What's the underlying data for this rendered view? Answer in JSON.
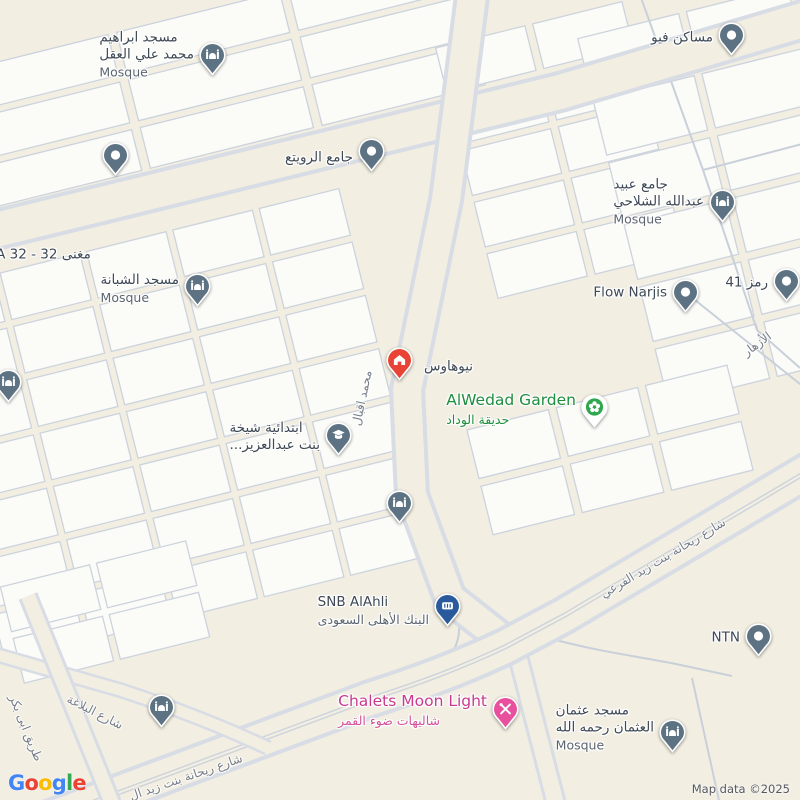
{
  "map": {
    "attribution": "Map data ©2025",
    "logo_letters": [
      {
        "ch": "G",
        "color": "#4285F4"
      },
      {
        "ch": "o",
        "color": "#EA4335"
      },
      {
        "ch": "o",
        "color": "#FBBC05"
      },
      {
        "ch": "g",
        "color": "#4285F4"
      },
      {
        "ch": "l",
        "color": "#34A853"
      },
      {
        "ch": "e",
        "color": "#EA4335"
      }
    ],
    "colors": {
      "background": "#f2eee2",
      "block": "#fbfbf8",
      "road_line": "#ccd3dd",
      "pin_slate": "#5d7383",
      "pin_red": "#e94335",
      "pin_green": "#2fa74e",
      "pin_blue": "#2a5a9c",
      "pin_pink": "#e8509e",
      "label_green": "#1e8e3e",
      "label_pink": "#c93a8e"
    }
  },
  "pois": [
    {
      "id": "masjid-ibrahim",
      "type": "mosque",
      "pin": {
        "x": 212,
        "y": 55
      },
      "label": {
        "lines": [
          "مسجد ابراهيم",
          "محمد علي العقل"
        ],
        "sub": "Mosque",
        "x": 194,
        "y": 55,
        "align": "right"
      }
    },
    {
      "id": "dot-west",
      "type": "dot",
      "pin": {
        "x": 115,
        "y": 155
      }
    },
    {
      "id": "jame-rowaita",
      "type": "dot",
      "pin": {
        "x": 371,
        "y": 151
      },
      "label": {
        "lines": [
          "جامع الرويتع"
        ],
        "x": 353,
        "y": 158,
        "align": "right"
      }
    },
    {
      "id": "masaken-view",
      "type": "dot",
      "pin": {
        "x": 731,
        "y": 35
      },
      "label": {
        "lines": [
          "مساكن فيو"
        ],
        "x": 713,
        "y": 38,
        "align": "right"
      }
    },
    {
      "id": "jame-obaid-alshalahi",
      "type": "mosque",
      "pin": {
        "x": 722,
        "y": 202
      },
      "label": {
        "lines": [
          "جامع عبيد",
          "عبدالله الشلاحي"
        ],
        "sub": "Mosque",
        "x": 704,
        "y": 202,
        "align": "right"
      }
    },
    {
      "id": "masjid-shabana",
      "type": "mosque",
      "pin": {
        "x": 197,
        "y": 286
      },
      "label": {
        "lines": [
          "مسجد الشبانة"
        ],
        "sub": "Mosque",
        "x": 179,
        "y": 289,
        "align": "right"
      }
    },
    {
      "id": "flow-narjis",
      "type": "dot",
      "pin": {
        "x": 685,
        "y": 292
      },
      "label": {
        "lines": [
          "Flow Narjis"
        ],
        "x": 667,
        "y": 293,
        "align": "right"
      }
    },
    {
      "id": "ramz-41",
      "type": "dot",
      "pin": {
        "x": 786,
        "y": 281
      },
      "label": {
        "lines": [
          "رمز 41"
        ],
        "x": 768,
        "y": 283,
        "align": "right"
      }
    },
    {
      "id": "mosque-west-edge",
      "type": "mosque",
      "pin": {
        "x": 8,
        "y": 382
      }
    },
    {
      "id": "newhouse",
      "type": "house",
      "pin": {
        "x": 399,
        "y": 360
      },
      "label": {
        "lines": [
          "نيوهاوس"
        ],
        "x": 424,
        "y": 367,
        "align": "left"
      }
    },
    {
      "id": "alwedad-garden",
      "type": "garden",
      "pin": {
        "x": 594,
        "y": 407
      },
      "label": {
        "lines": [
          "AlWedad Garden"
        ],
        "sub": "حديقة الوداد",
        "x": 576,
        "y": 410,
        "align": "right",
        "color": "#1e8e3e",
        "sub_color": "#1e8e3e",
        "big": true
      }
    },
    {
      "id": "school-shaikha-bint-abdulaziz",
      "type": "school",
      "pin": {
        "x": 338,
        "y": 435
      },
      "label": {
        "lines": [
          "ابتدائية شيخة",
          "بنت عبدالعزيز..."
        ],
        "x": 320,
        "y": 437,
        "align": "right"
      }
    },
    {
      "id": "mosque-mid",
      "type": "mosque",
      "pin": {
        "x": 399,
        "y": 503
      }
    },
    {
      "id": "snb-alahli",
      "type": "bank",
      "pin": {
        "x": 447,
        "y": 606
      },
      "label": {
        "lines": [
          "SNB AlAhli"
        ],
        "sub": "البنك الأهلى السعودى",
        "x": 429,
        "y": 611,
        "align": "right"
      }
    },
    {
      "id": "chalets-moon-light",
      "type": "tools",
      "pin": {
        "x": 505,
        "y": 709
      },
      "label": {
        "lines": [
          "Chalets Moon Light"
        ],
        "sub": "شاليهات ضوء القمر",
        "x": 487,
        "y": 711,
        "align": "right",
        "color": "#c93a8e",
        "sub_color": "#d3539b",
        "big": true
      }
    },
    {
      "id": "ntn",
      "type": "dot",
      "pin": {
        "x": 758,
        "y": 636
      },
      "label": {
        "lines": [
          "NTN"
        ],
        "x": 740,
        "y": 638,
        "align": "right"
      }
    },
    {
      "id": "masjid-othman",
      "type": "mosque",
      "pin": {
        "x": 672,
        "y": 732
      },
      "label": {
        "lines": [
          "مسجد عثمان",
          "العثمان رحمه الله"
        ],
        "sub": "Mosque",
        "x": 654,
        "y": 728,
        "align": "right"
      }
    },
    {
      "id": "mosque-southwest",
      "type": "mosque",
      "pin": {
        "x": 161,
        "y": 707
      }
    },
    {
      "id": "maghna-na-32",
      "type": "none",
      "label": {
        "lines": [
          "مغنى NA 32 - 32"
        ],
        "x": -14,
        "y": 255,
        "align": "left"
      }
    }
  ],
  "street_labels": [
    {
      "text": "محمد اقبال",
      "x": 362,
      "y": 398,
      "angle": -78
    },
    {
      "text": "شارع ريحانة بنت زيد الفرعي",
      "x": 663,
      "y": 558,
      "angle": -31
    },
    {
      "text": "الأزهار",
      "x": 757,
      "y": 344,
      "angle": -36
    },
    {
      "text": "شارع البلاغة",
      "x": 95,
      "y": 712,
      "angle": 27
    },
    {
      "text": "طريق ابى بكر",
      "x": 26,
      "y": 728,
      "angle": 68
    },
    {
      "text": "شارع ريحانة بنت زيد ال",
      "x": 186,
      "y": 777,
      "angle": -19
    }
  ]
}
